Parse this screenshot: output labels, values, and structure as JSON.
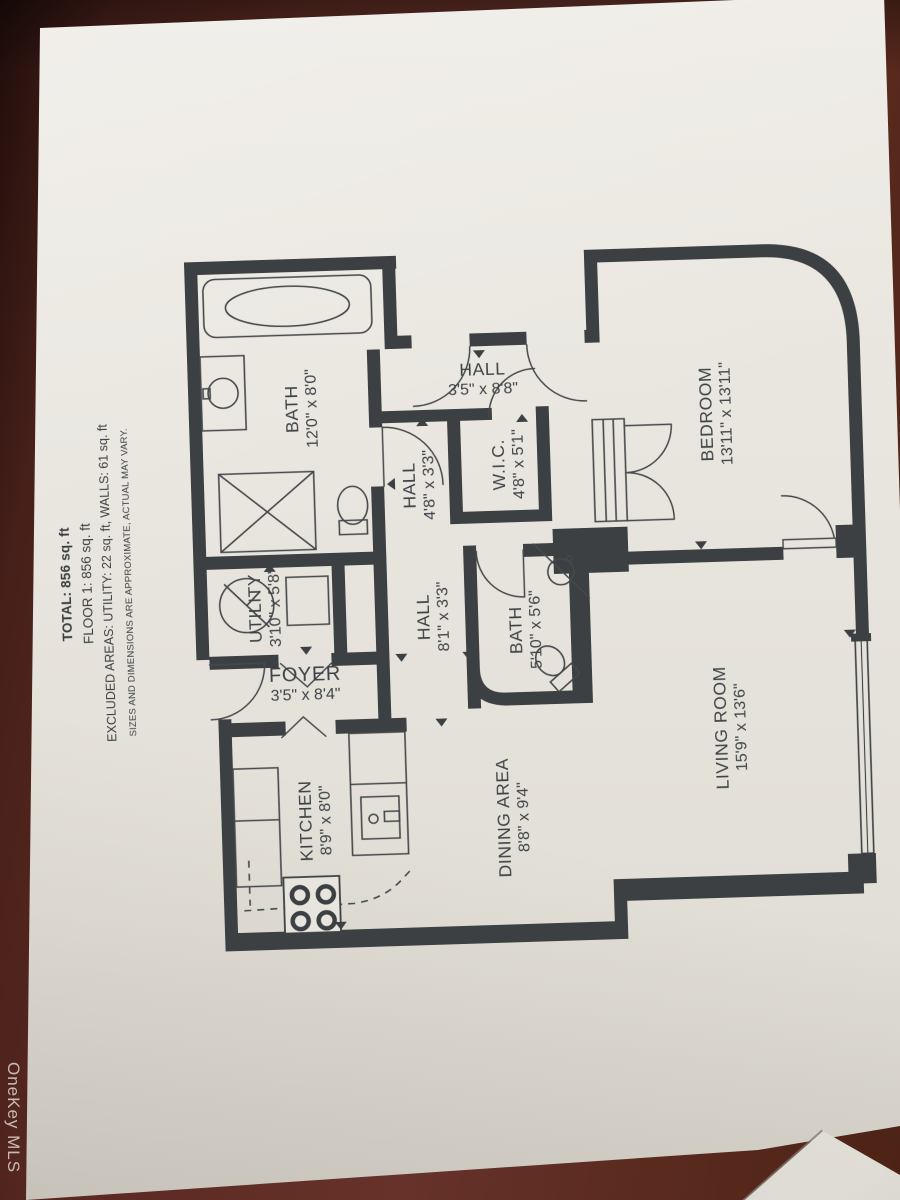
{
  "watermark": "OneKey MLS",
  "summary": {
    "total": "TOTAL: 856 sq. ft",
    "floor": "FLOOR 1: 856 sq. ft",
    "excluded": "EXCLUDED AREAS: UTILITY: 22 sq. ft, WALLS: 61 sq. ft",
    "disclaimer": "SIZES AND DIMENSIONS ARE APPROXIMATE, ACTUAL MAY VARY."
  },
  "rooms": [
    {
      "name": "BEDROOM",
      "dims": "13'11\" x 13'11\""
    },
    {
      "name": "LIVING ROOM",
      "dims": "15'9\" x 13'6\""
    },
    {
      "name": "DINING AREA",
      "dims": "8'8\" x 9'4\""
    },
    {
      "name": "KITCHEN",
      "dims": "8'9\" x 8'0\""
    },
    {
      "name": "BATH",
      "dims": "12'0\" x 8'0\""
    },
    {
      "name": "BATH",
      "dims": "5'10\" x 5'6\""
    },
    {
      "name": "W.I.C.",
      "dims": "4'8\" x 5'1\""
    },
    {
      "name": "UTILITY",
      "dims": "3'10\" x 5'8\""
    },
    {
      "name": "HALL",
      "dims": "3'5\" x 8'8\""
    },
    {
      "name": "HALL",
      "dims": "4'8\" x 3'3\""
    },
    {
      "name": "HALL",
      "dims": "8'1\" x 3'3\""
    },
    {
      "name": "FOYER",
      "dims": "3'5\" x 8'4\""
    }
  ],
  "colors": {
    "table_background": "#5c2a22",
    "paper": "#e8e5de",
    "plan_walls": "#3c4043",
    "plan_text": "#3f4347",
    "watermark_text": "#e4dcd6"
  }
}
